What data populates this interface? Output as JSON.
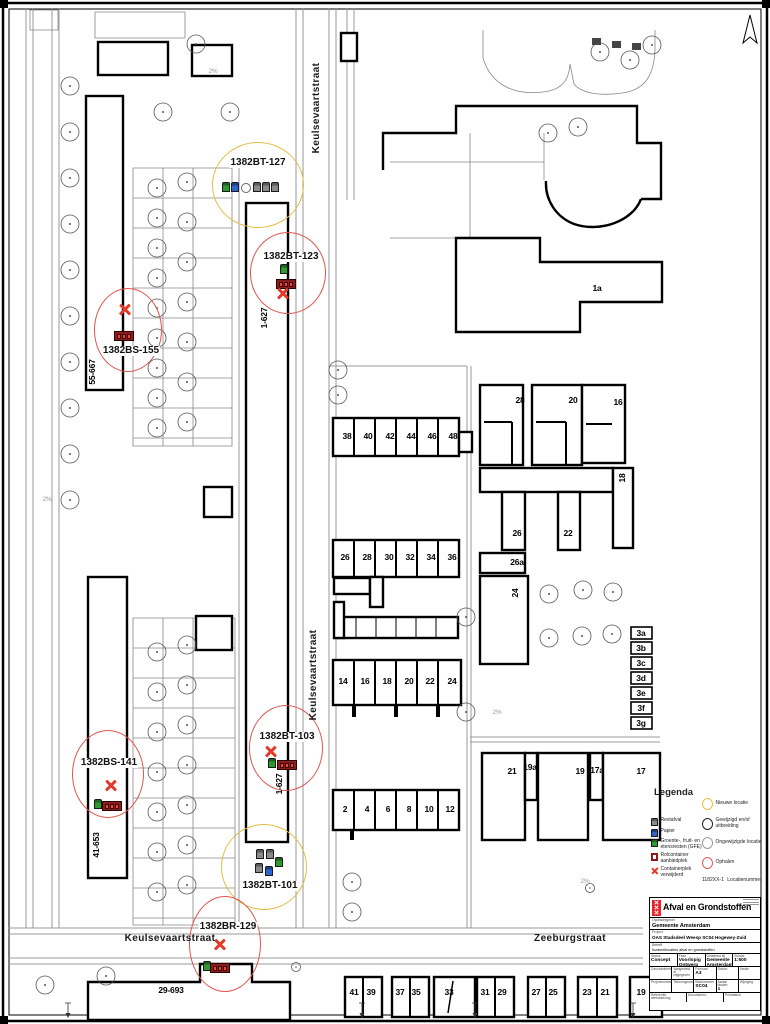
{
  "map": {
    "labels": [
      {
        "t": "Keulsevaartstraat",
        "x": 317,
        "y": 108,
        "rot": 1,
        "cls": "street"
      },
      {
        "t": "Keulsevaartstraat",
        "x": 314,
        "y": 675,
        "rot": 1,
        "cls": "street"
      },
      {
        "t": "Keulsevaartstraat",
        "x": 170,
        "y": 939,
        "cls": "street"
      },
      {
        "t": "Zeeburgstraat",
        "x": 570,
        "y": 939,
        "cls": "street"
      },
      {
        "t": "55-667",
        "x": 92,
        "y": 372,
        "rot": 1
      },
      {
        "t": "41-653",
        "x": 96,
        "y": 845,
        "rot": 1
      },
      {
        "t": "1-627",
        "x": 264,
        "y": 318,
        "rot": 1
      },
      {
        "t": "1-627",
        "x": 279,
        "y": 784,
        "rot": 1
      },
      {
        "t": "29-693",
        "x": 171,
        "y": 990
      },
      {
        "t": "1a",
        "x": 597,
        "y": 288
      },
      {
        "t": "38",
        "x": 347,
        "y": 436
      },
      {
        "t": "40",
        "x": 368,
        "y": 436
      },
      {
        "t": "42",
        "x": 390,
        "y": 436
      },
      {
        "t": "44",
        "x": 411,
        "y": 436
      },
      {
        "t": "46",
        "x": 432,
        "y": 436
      },
      {
        "t": "48",
        "x": 453,
        "y": 436
      },
      {
        "t": "26",
        "x": 345,
        "y": 557
      },
      {
        "t": "28",
        "x": 367,
        "y": 557
      },
      {
        "t": "30",
        "x": 389,
        "y": 557
      },
      {
        "t": "32",
        "x": 410,
        "y": 557
      },
      {
        "t": "34",
        "x": 431,
        "y": 557
      },
      {
        "t": "36",
        "x": 452,
        "y": 557
      },
      {
        "t": "14",
        "x": 343,
        "y": 681
      },
      {
        "t": "16",
        "x": 365,
        "y": 681
      },
      {
        "t": "18",
        "x": 387,
        "y": 681
      },
      {
        "t": "20",
        "x": 409,
        "y": 681
      },
      {
        "t": "22",
        "x": 430,
        "y": 681
      },
      {
        "t": "24",
        "x": 452,
        "y": 681
      },
      {
        "t": "2",
        "x": 345,
        "y": 809
      },
      {
        "t": "4",
        "x": 367,
        "y": 809
      },
      {
        "t": "6",
        "x": 388,
        "y": 809
      },
      {
        "t": "8",
        "x": 409,
        "y": 809
      },
      {
        "t": "10",
        "x": 429,
        "y": 809
      },
      {
        "t": "12",
        "x": 450,
        "y": 809
      },
      {
        "t": "28",
        "x": 520,
        "y": 400
      },
      {
        "t": "20",
        "x": 573,
        "y": 400
      },
      {
        "t": "16",
        "x": 618,
        "y": 402
      },
      {
        "t": "18",
        "x": 622,
        "y": 478,
        "rot": 1
      },
      {
        "t": "26",
        "x": 517,
        "y": 533
      },
      {
        "t": "22",
        "x": 568,
        "y": 533
      },
      {
        "t": "26a",
        "x": 517,
        "y": 562
      },
      {
        "t": "24",
        "x": 515,
        "y": 593,
        "rot": 1
      },
      {
        "t": "3a",
        "x": 641,
        "y": 633
      },
      {
        "t": "3b",
        "x": 641,
        "y": 648
      },
      {
        "t": "3c",
        "x": 641,
        "y": 663
      },
      {
        "t": "3d",
        "x": 641,
        "y": 678
      },
      {
        "t": "3e",
        "x": 641,
        "y": 693
      },
      {
        "t": "3f",
        "x": 641,
        "y": 708
      },
      {
        "t": "3g",
        "x": 641,
        "y": 723
      },
      {
        "t": "21",
        "x": 512,
        "y": 771
      },
      {
        "t": "19a",
        "x": 530,
        "y": 767
      },
      {
        "t": "19",
        "x": 580,
        "y": 771
      },
      {
        "t": "17a",
        "x": 597,
        "y": 770
      },
      {
        "t": "17",
        "x": 641,
        "y": 771
      },
      {
        "t": "41",
        "x": 354,
        "y": 992
      },
      {
        "t": "39",
        "x": 371,
        "y": 992
      },
      {
        "t": "37",
        "x": 400,
        "y": 992
      },
      {
        "t": "35",
        "x": 416,
        "y": 992
      },
      {
        "t": "33",
        "x": 449,
        "y": 992
      },
      {
        "t": "31",
        "x": 485,
        "y": 992
      },
      {
        "t": "29",
        "x": 502,
        "y": 992
      },
      {
        "t": "27",
        "x": 536,
        "y": 992
      },
      {
        "t": "25",
        "x": 553,
        "y": 992
      },
      {
        "t": "23",
        "x": 587,
        "y": 992
      },
      {
        "t": "21",
        "x": 605,
        "y": 992
      },
      {
        "t": "19",
        "x": 641,
        "y": 992
      },
      {
        "t": "2%",
        "x": 213,
        "y": 72,
        "cls": "slope"
      },
      {
        "t": "2%",
        "x": 47,
        "y": 500,
        "cls": "slope"
      },
      {
        "t": "2%",
        "x": 497,
        "y": 713,
        "cls": "slope"
      },
      {
        "t": "2%",
        "x": 585,
        "y": 882,
        "cls": "slope"
      }
    ]
  },
  "locations": [
    {
      "id": "1382BT-127",
      "status": "nieuwe locatie"
    },
    {
      "id": "1382BT-123",
      "status": "ophalen"
    },
    {
      "id": "1382BS-155",
      "status": "ophalen"
    },
    {
      "id": "1382BS-141",
      "status": "ophalen"
    },
    {
      "id": "1382BT-103",
      "status": "ophalen"
    },
    {
      "id": "1382BT-101",
      "status": "nieuwe locatie"
    },
    {
      "id": "1382BR-129",
      "status": "ophalen"
    }
  ],
  "legend": {
    "title": "Legenda",
    "waste_items": [
      {
        "label": "Restafval",
        "cls": "ic-bin",
        "color": "#8a8a8a"
      },
      {
        "label": "Papier",
        "cls": "ic-bin",
        "color": "#2f63cc"
      },
      {
        "label": "Groente-, fruit- en etensresten (GFE)",
        "cls": "ic-bin",
        "color": "#2f9a2f"
      },
      {
        "label": "Rolcontainer aanbiedplek",
        "cls": "ic-box",
        "color": "#8b1c1c"
      },
      {
        "label": "Containerplek verwijderd",
        "cls": "ic-x",
        "color": "#e23b2a"
      }
    ],
    "status_items": [
      {
        "label": "Nieuwe locatie",
        "color": "#e3c04a"
      },
      {
        "label": "Gewijzigd en/of uitbreiding",
        "color": "#222222"
      },
      {
        "label": "Ongewijzigde locatie",
        "color": "#9a9a9a"
      },
      {
        "label": "Ophalen",
        "color": "#e05a52"
      }
    ],
    "location_number_example": "1182XX-1",
    "location_number_label": "Locatienummer"
  },
  "title_block": {
    "title": "Afval en Grondstoffen",
    "client_label": "Opdrachtgever",
    "client": "Gemeente Amsterdam",
    "project_label": "Project",
    "project": "OAS Stadsdeel Weesp SC04 Hogewey-Zuid",
    "subject_label": "Betreft",
    "subject": "Inzamellocaties afval en grondstoffen",
    "grid_rows": [
      [
        {
          "l": "Status",
          "v": "Concept"
        },
        {
          "l": "Fase",
          "v": "Voorlopig Ontwerp"
        },
        {
          "l": "Getekend bij",
          "v": "Gemeente Amsterdam"
        },
        {
          "l": "Schaal",
          "v": "1:500"
        }
      ],
      [
        {
          "l": "Gecontroleerd",
          "v": ""
        },
        {
          "l": "Vastgesteld of vrijgegeven",
          "v": ""
        },
        {
          "l": "Formaat",
          "v": "A3"
        },
        {
          "l": "Datum",
          "v": ""
        },
        {
          "l": "Versie",
          "v": ""
        }
      ],
      [
        {
          "l": "Projectnummer",
          "v": ""
        },
        {
          "l": "Tekeningnummer",
          "v": ""
        },
        {
          "l": "Bladnummer",
          "v": "SC04"
        },
        {
          "l": "Aantal bladen",
          "v": "1"
        },
        {
          "l": "Wijziging",
          "v": ""
        }
      ],
      [
        {
          "l": "Referentie werktekening",
          "v": ""
        },
        {
          "l": "Documentnr.",
          "v": ""
        },
        {
          "l": "Printdatum",
          "v": ""
        }
      ]
    ]
  }
}
